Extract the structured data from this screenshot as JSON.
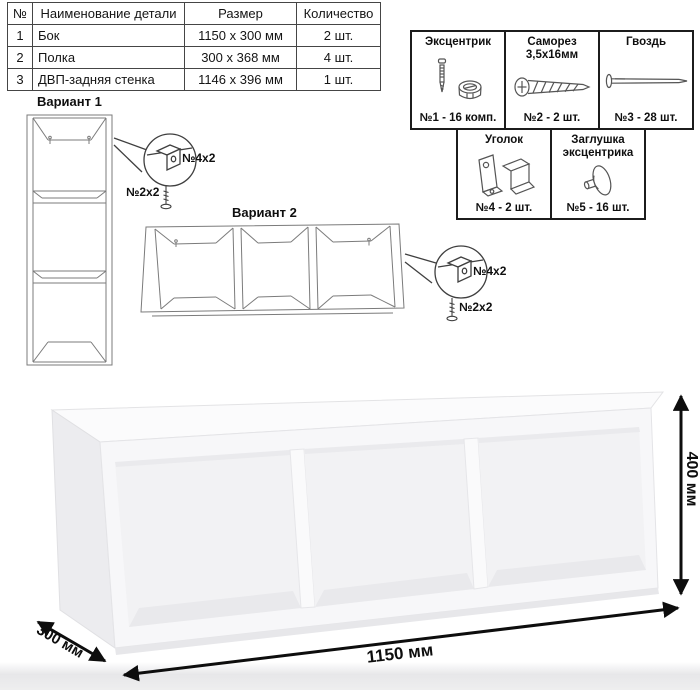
{
  "colors": {
    "line_art": "#7b7b7b",
    "ink": "#111111",
    "dimension": "#0d0d0d"
  },
  "parts_table": {
    "headers": {
      "num": "№",
      "name": "Наименование детали",
      "size": "Размер",
      "qty": "Количество"
    },
    "rows": [
      {
        "num": "1",
        "name": "Бок",
        "size": "1150 x 300 мм",
        "qty": "2 шт."
      },
      {
        "num": "2",
        "name": "Полка",
        "size": "300 x 368 мм",
        "qty": "4 шт."
      },
      {
        "num": "3",
        "name": "ДВП-задняя стенка",
        "size": "1146 x 396 мм",
        "qty": "1 шт."
      }
    ]
  },
  "hardware": {
    "items": [
      {
        "title": "Эксцентрик",
        "subtitle": "",
        "count": "№1 - 16 комп.",
        "icon": "cam-bolt-icon"
      },
      {
        "title": "Саморез",
        "subtitle": "3,5х16мм",
        "count": "№2 - 2 шт.",
        "icon": "screw-icon"
      },
      {
        "title": "Гвоздь",
        "subtitle": "",
        "count": "№3 - 28 шт.",
        "icon": "nail-icon"
      },
      {
        "title": "Уголок",
        "subtitle": "",
        "count": "№4 - 2 шт.",
        "icon": "corner-bracket-icon"
      },
      {
        "title": "Заглушка",
        "subtitle": "эксцентрика",
        "count": "№5 - 16 шт.",
        "icon": "cap-icon"
      }
    ]
  },
  "variants": [
    {
      "title": "Вариант 1",
      "bracket_label": "№4х2",
      "screw_label": "№2х2"
    },
    {
      "title": "Вариант 2",
      "bracket_label": "№4х2",
      "screw_label": "№2х2"
    }
  ],
  "dimensions": {
    "width": "1150 мм",
    "depth": "300 мм",
    "height": "400 мм"
  }
}
